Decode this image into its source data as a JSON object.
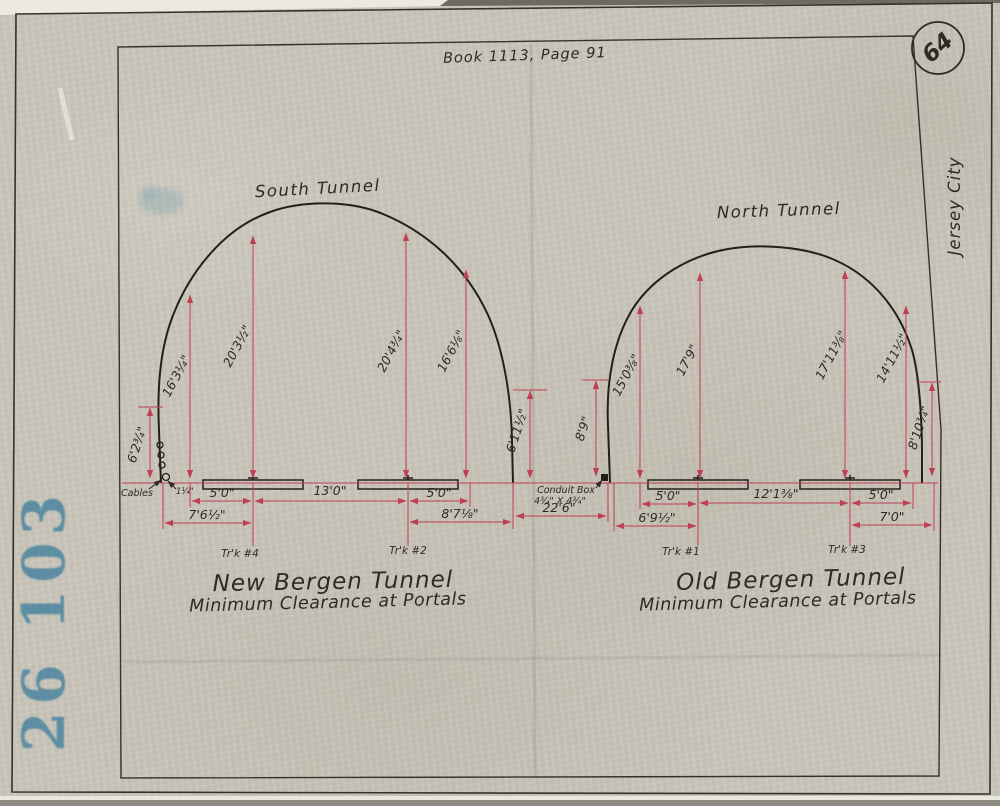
{
  "header": {
    "book_ref": "Book 1113, Page 91",
    "sheet_number": "64",
    "margin_label": "Jersey City",
    "stamp_number": "26 103"
  },
  "south": {
    "label": "South Tunnel",
    "title": "New Bergen Tunnel",
    "subtitle": "Minimum Clearance at Portals",
    "heights": {
      "wall_left": "6'2¾\"",
      "h1": "16'3¼\"",
      "h2": "20'3½\"",
      "h3": "20'4¾\"",
      "h4": "16'6⅛\"",
      "wall_right": "6'11½\""
    },
    "widths": {
      "gauge_left": "5'0\"",
      "center": "13'0\"",
      "gauge_right": "5'0\"",
      "offset_left": "7'6½\"",
      "offset_right": "8'7⅛\""
    },
    "tracks": {
      "left": "Tr'k #4",
      "right": "Tr'k #2"
    },
    "cables_label": "Cables",
    "cable_offset": "1¼\""
  },
  "middle": {
    "separation": "22'6\"",
    "conduit_height": "8'9\"",
    "conduit_label": "Conduit Box",
    "conduit_size": "4¾\" X 4¾\""
  },
  "north": {
    "label": "North Tunnel",
    "title": "Old Bergen Tunnel",
    "subtitle": "Minimum Clearance at Portals",
    "heights": {
      "h1": "15'0⅜\"",
      "h2": "17'9\"",
      "h3": "17'11⅜\"",
      "h4": "14'11½\"",
      "wall_right": "8'10¾\""
    },
    "widths": {
      "gauge_left": "5'0\"",
      "center": "12'1⅜\"",
      "gauge_right": "5'0\"",
      "offset_left": "6'9½\"",
      "offset_right": "7'0\""
    },
    "tracks": {
      "left": "Tr'k #1",
      "right": "Tr'k #3"
    }
  },
  "colors": {
    "paper": "#c9c5ba",
    "ink": "#2e2a24",
    "dimension_line": "#bf3f55",
    "stamp_blue": "#3f7f9e"
  }
}
